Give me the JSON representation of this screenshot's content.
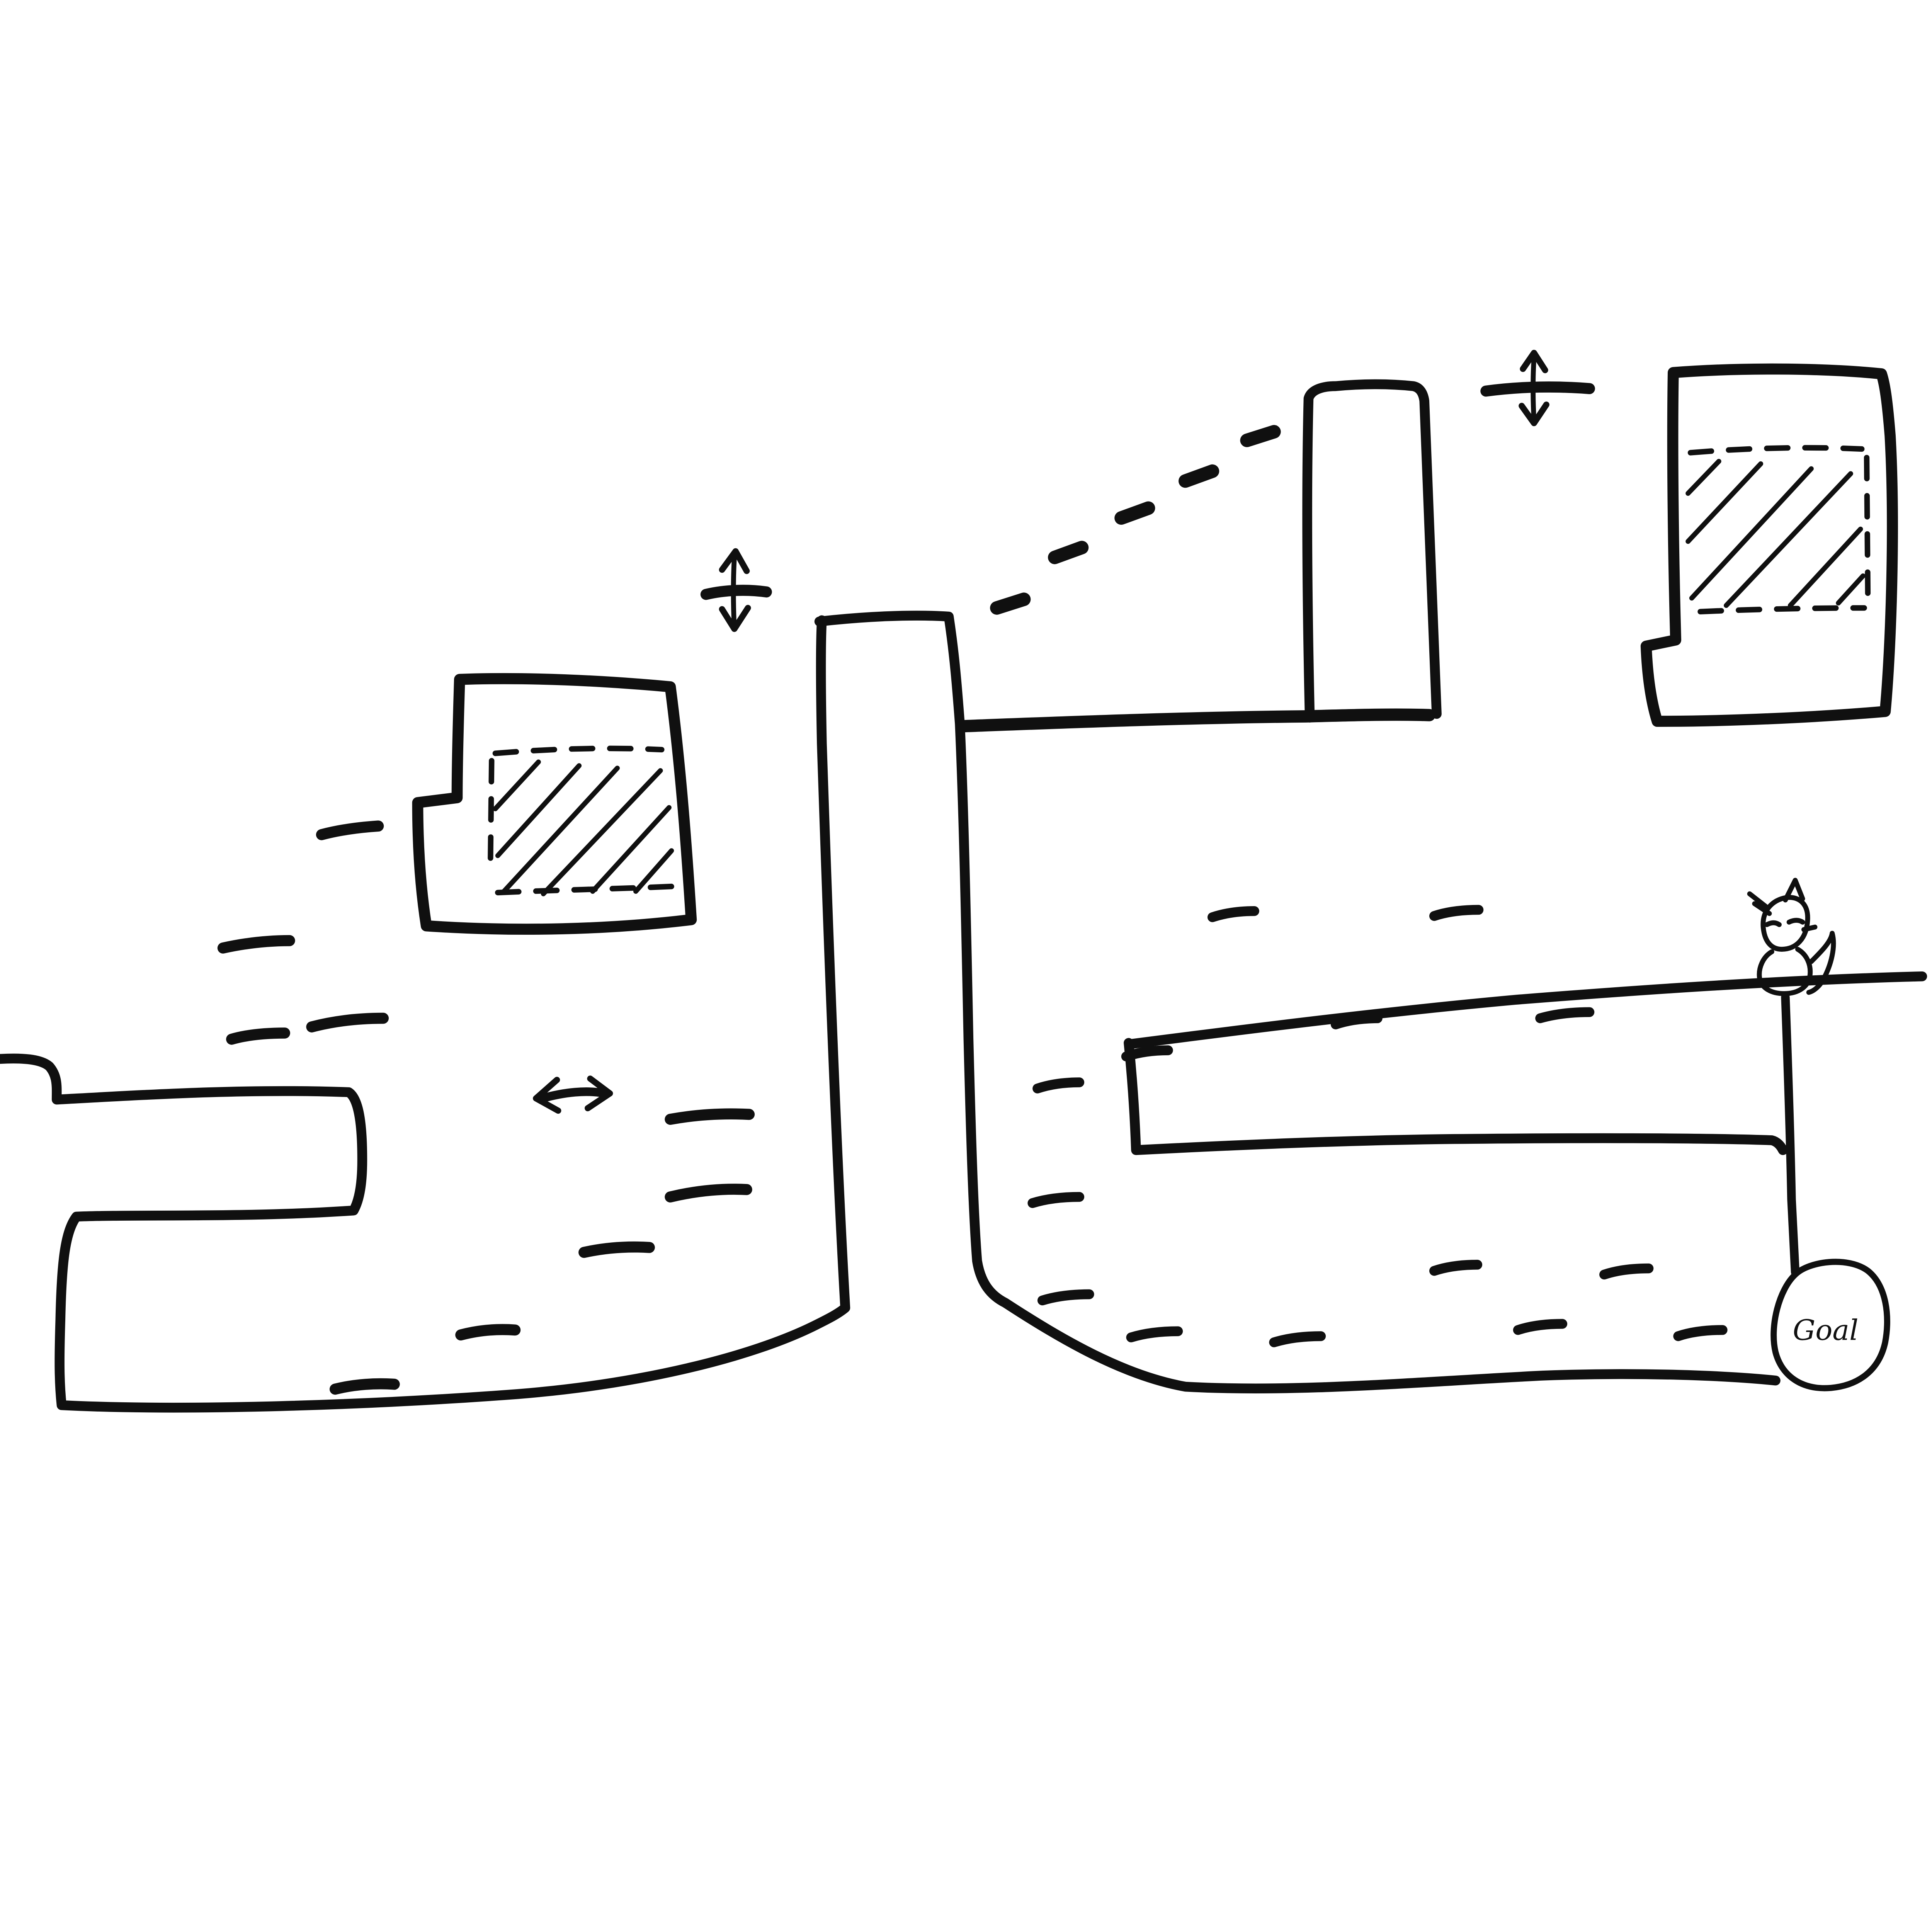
{
  "canvas": {
    "background": "#ffffff",
    "ink": "#101010",
    "kind": "hand-drawn platformer level sketch"
  },
  "goal": {
    "label": "Goal"
  },
  "legend": {
    "vertical_move_glyph": "platform bar crossed by an up-down double arrow (moves vertically)",
    "horizontal_move_arrow": "left-right double arrow (moves horizontally)",
    "hatched_block": "block with dashed inner square filled with diagonal hatching",
    "dashed_trail": "dotted jump path rising toward upper platform",
    "texture_dash": "short ground texture tick"
  },
  "elements": [
    {
      "name": "left-ledge-and-ground",
      "type": "terrain"
    },
    {
      "name": "hatched-block-left",
      "type": "hatched_block"
    },
    {
      "name": "vertical-move-glyph-left",
      "type": "vertical_move_glyph"
    },
    {
      "name": "horizontal-move-arrow",
      "type": "horizontal_move_arrow"
    },
    {
      "name": "center-pillar-and-arm",
      "type": "terrain"
    },
    {
      "name": "dashed-jump-trail",
      "type": "dashed_trail",
      "dash_count": 5
    },
    {
      "name": "upper-right-bar",
      "type": "terrain"
    },
    {
      "name": "vertical-move-glyph-right",
      "type": "vertical_move_glyph"
    },
    {
      "name": "hatched-block-right",
      "type": "hatched_block"
    },
    {
      "name": "right-structure",
      "type": "terrain"
    },
    {
      "name": "cat-sprite",
      "type": "character"
    },
    {
      "name": "goal-circle",
      "type": "goal_marker",
      "label": "Goal"
    }
  ]
}
